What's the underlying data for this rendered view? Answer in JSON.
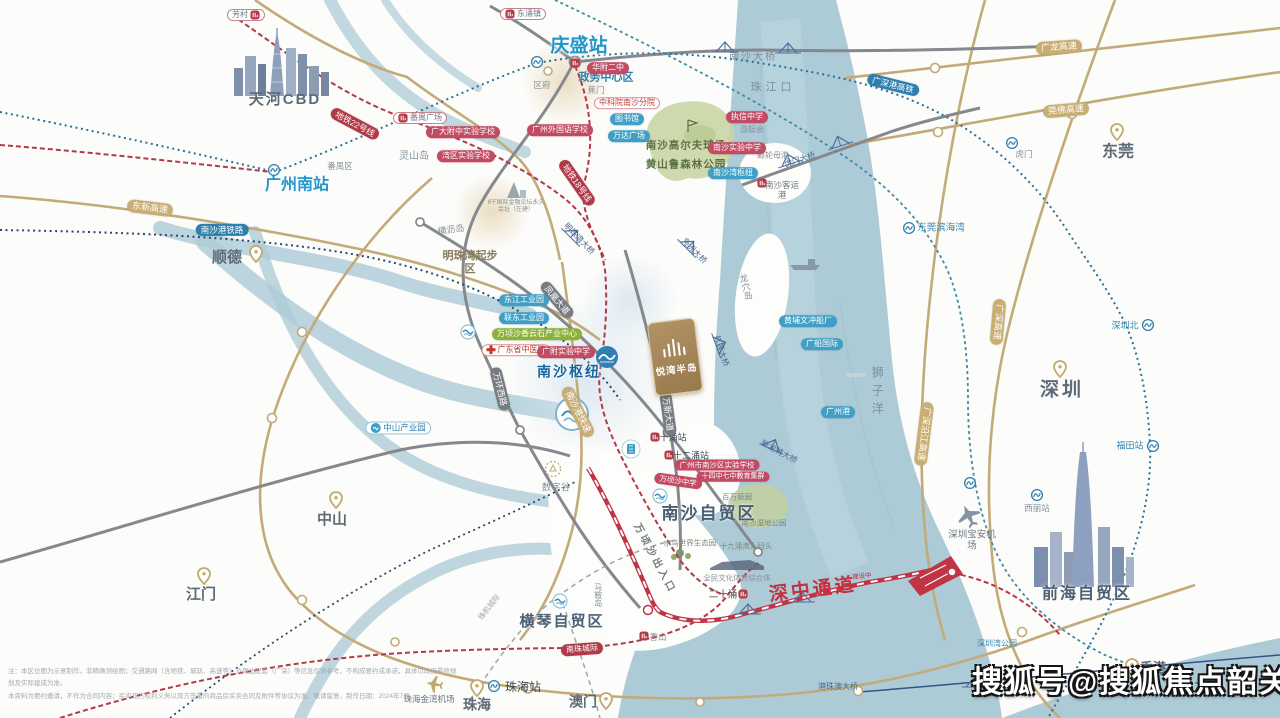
{
  "watermark": "搜狐号@搜狐焦点韶关站",
  "project": {
    "name": "悦湾半岛"
  },
  "disclaimer": {
    "line1": "注：本区位图为示意制作，非精确测绘图；交通路网（含地铁、城轨、高速等）及周边配套（广深）等信息仅供参考，不构成要约或承诺，具体以政府最终规划及实际建成为准。",
    "line2": "本资料为要约邀请，不作为合同内容；买卖双方权利义务以双方签署的商品房买卖合同及附件等协议为准。敬请留意，制作日期：2024年7月。"
  },
  "colors": {
    "water": "#adcbd7",
    "road_gold": "#c3aa79",
    "road_gray": "#85898d",
    "metro_red": "#b23a48",
    "rail_blue": "#2c6f96",
    "corridor_red": "#c03445",
    "station_blue": "#2196cb",
    "pill_red": "#c34a62",
    "pill_blue": "#3f9fc6",
    "pill_green": "#8ab236"
  },
  "labels": [
    {
      "n": "label-tianhe-cbd",
      "t": "天河CBD",
      "c": "city",
      "x": 285,
      "y": 100,
      "fs": 15,
      "ls": 2
    },
    {
      "n": "label-shunde",
      "t": "顺德",
      "c": "city",
      "x": 227,
      "y": 258,
      "fs": 15
    },
    {
      "n": "pin-shunde",
      "t": "",
      "c": "pin",
      "x": 256,
      "y": 254
    },
    {
      "n": "label-dongguan",
      "t": "东莞",
      "c": "city",
      "x": 1118,
      "y": 152,
      "fs": 16
    },
    {
      "n": "pin-dongguan",
      "t": "",
      "c": "pin",
      "x": 1117,
      "y": 132
    },
    {
      "n": "label-shenzhen",
      "t": "深圳",
      "c": "city",
      "x": 1062,
      "y": 391,
      "fs": 19,
      "ls": 3
    },
    {
      "n": "pin-shenzhen",
      "t": "",
      "c": "pin",
      "x": 1060,
      "y": 369
    },
    {
      "n": "label-zhongshan",
      "t": "中山",
      "c": "city",
      "x": 332,
      "y": 520,
      "fs": 15
    },
    {
      "n": "pin-zhongshan",
      "t": "",
      "c": "pin",
      "x": 336,
      "y": 500
    },
    {
      "n": "label-jiangmen",
      "t": "江门",
      "c": "city",
      "x": 201,
      "y": 595,
      "fs": 15
    },
    {
      "n": "pin-jiangmen",
      "t": "",
      "c": "pin",
      "x": 204,
      "y": 576
    },
    {
      "n": "label-zhuhai",
      "t": "珠海",
      "c": "city",
      "x": 477,
      "y": 705,
      "fs": 14
    },
    {
      "n": "pin-zhuhai",
      "t": "",
      "c": "pin",
      "x": 477,
      "y": 688
    },
    {
      "n": "label-aomen",
      "t": "澳门",
      "c": "city",
      "x": 583,
      "y": 702,
      "fs": 14
    },
    {
      "n": "pin-aomen",
      "t": "",
      "c": "pin",
      "x": 606,
      "y": 701
    },
    {
      "n": "label-xianggang",
      "t": "香港",
      "c": "city",
      "x": 1153,
      "y": 668,
      "fs": 13
    },
    {
      "n": "pin-xianggang",
      "t": "",
      "c": "pin",
      "x": 1132,
      "y": 667
    },
    {
      "n": "label-qingsheng-station",
      "t": "庆盛站",
      "c": "sta-blue",
      "x": 579,
      "y": 47,
      "fs": 19
    },
    {
      "n": "label-guangzhounan-station",
      "t": "广州南站",
      "c": "sta-blue",
      "x": 297,
      "y": 185,
      "fs": 16
    },
    {
      "n": "label-nansha-hub",
      "t": "南沙枢纽",
      "c": "hub",
      "x": 569,
      "y": 372,
      "fs": 14,
      "ls": 2
    },
    {
      "n": "label-zhujiangkou",
      "t": "珠江口",
      "c": "sea",
      "x": 773,
      "y": 88,
      "fs": 11,
      "ls": 4
    },
    {
      "n": "label-shiziyang",
      "t": "狮子洋",
      "c": "sea-v",
      "x": 877,
      "y": 393,
      "fs": 12,
      "ls": 6
    },
    {
      "n": "label-longxuedao",
      "t": "龙穴岛",
      "c": "isl-v",
      "x": 745,
      "y": 287,
      "fs": 9,
      "r": -14
    },
    {
      "n": "label-maandao",
      "t": "马鞍岛",
      "c": "isl-v",
      "x": 598,
      "y": 595,
      "fs": 8
    },
    {
      "n": "label-henglidao",
      "t": "横沥岛",
      "c": "isl",
      "x": 451,
      "y": 230,
      "fs": 9,
      "r": -8
    },
    {
      "n": "label-lingshandao",
      "t": "灵山岛",
      "c": "isl",
      "x": 414,
      "y": 157,
      "fs": 10
    },
    {
      "n": "label-panyuqu",
      "t": "番禺区",
      "c": "isl",
      "x": 340,
      "y": 166,
      "fs": 8.5
    },
    {
      "n": "label-qufu",
      "t": "区府",
      "c": "isl",
      "x": 542,
      "y": 85,
      "fs": 8.5
    },
    {
      "n": "label-jiaomen",
      "t": "蕉门",
      "c": "isl",
      "x": 596,
      "y": 90,
      "fs": 8.5
    },
    {
      "n": "label-shenzhenwan-park",
      "t": "深圳湾公园",
      "c": "small-blue",
      "x": 997,
      "y": 644,
      "fs": 8
    },
    {
      "n": "label-shenzhen-north",
      "t": "深圳北",
      "c": "small-blue",
      "x": 1125,
      "y": 326,
      "fs": 9
    },
    {
      "n": "label-futian-station",
      "t": "福田站",
      "c": "small-blue",
      "x": 1130,
      "y": 446,
      "fs": 9
    },
    {
      "n": "label-xili-station",
      "t": "西丽站",
      "c": "isl",
      "x": 1037,
      "y": 508,
      "fs": 8.5
    },
    {
      "n": "label-humen",
      "t": "虎门",
      "c": "isl",
      "x": 1024,
      "y": 154,
      "fs": 8.5
    },
    {
      "n": "label-dongguan-binhaiwan",
      "t": "东莞滨海湾",
      "c": "small-blue",
      "x": 941,
      "y": 228,
      "fs": 9.5
    },
    {
      "n": "label-zhuhai-station",
      "t": "珠海站",
      "c": "sta-dark",
      "x": 523,
      "y": 687,
      "fs": 12
    },
    {
      "n": "label-shuzigu",
      "t": "数字谷",
      "c": "isl",
      "x": 556,
      "y": 488,
      "fs": 9.5
    },
    {
      "n": "label-qianhai-zone",
      "t": "前海自贸区",
      "c": "zone",
      "x": 1087,
      "y": 594,
      "fs": 16,
      "ls": 2
    },
    {
      "n": "label-nansha-zone",
      "t": "南沙自贸区",
      "c": "zone",
      "x": 709,
      "y": 514,
      "fs": 17,
      "ls": 2
    },
    {
      "n": "label-hengqin-zone",
      "t": "横琴自贸区",
      "c": "zone",
      "x": 562,
      "y": 622,
      "fs": 15,
      "ls": 2
    },
    {
      "n": "label-shenzhong-corridor",
      "t": "深中通道",
      "c": "corridor",
      "x": 813,
      "y": 591,
      "fs": 19,
      "r": -7,
      "ls": 3
    },
    {
      "n": "label-corridor-note",
      "t": "建设中",
      "c": "corridor-sub",
      "x": 862,
      "y": 577,
      "fs": 6.5,
      "r": -7
    },
    {
      "n": "label-shenzhen-airport",
      "t": "深圳宝安机场",
      "c": "city-sm",
      "x": 972,
      "y": 541,
      "fs": 9.5,
      "w": 50
    },
    {
      "n": "label-zhuhai-airport",
      "t": "珠海金湾机场",
      "c": "city-sm",
      "x": 429,
      "y": 699,
      "fs": 8.5
    },
    {
      "n": "label-nansha-bridge",
      "t": "南沙大桥",
      "c": "sea",
      "x": 753,
      "y": 58,
      "fs": 10,
      "ls": 2
    },
    {
      "n": "label-hzm-bridge",
      "t": "港珠澳大桥",
      "c": "bridge",
      "x": 838,
      "y": 687,
      "fs": 8
    },
    {
      "n": "label-mingzhuwan",
      "t": "明珠湾起步区",
      "c": "dist",
      "x": 470,
      "y": 263,
      "fs": 11,
      "w": 56
    },
    {
      "n": "label-zhengwu",
      "t": "政务中心区",
      "c": "area",
      "x": 606,
      "y": 78,
      "fs": 11
    },
    {
      "n": "label-nansha-keyungang",
      "t": "南沙客运港",
      "c": "city-sm",
      "x": 782,
      "y": 190,
      "fs": 8.5,
      "w": 40
    },
    {
      "n": "label-youtinghui",
      "t": "游艇会",
      "c": "isl",
      "x": 752,
      "y": 130,
      "fs": 8
    },
    {
      "n": "label-youlun-mugang",
      "t": "邮轮母港",
      "c": "isl",
      "x": 773,
      "y": 156,
      "fs": 8
    },
    {
      "n": "label-nansha-golf",
      "t": "南沙高尔夫球场",
      "c": "park",
      "x": 686,
      "y": 146,
      "fs": 10.5,
      "ls": 1
    },
    {
      "n": "label-huangshanlu",
      "t": "黄山鲁森林公园",
      "c": "park",
      "x": 686,
      "y": 165,
      "fs": 10.5,
      "ls": 1
    },
    {
      "n": "label-nanshawan-hub",
      "t": "南沙湾枢纽",
      "c": "pill-blue",
      "x": 733,
      "y": 173,
      "fs": 8
    },
    {
      "n": "label-iff",
      "t": "IFF国际金融论坛永久会址（在建）",
      "c": "tiny",
      "x": 516,
      "y": 207,
      "fs": 6,
      "w": 58
    },
    {
      "n": "label-shuiniao",
      "t": "水鸟世界生态园",
      "c": "tiny2",
      "x": 690,
      "y": 543,
      "fs": 7.5
    },
    {
      "n": "label-baiwankuiyuan",
      "t": "百万葵园",
      "c": "tiny2",
      "x": 737,
      "y": 497,
      "fs": 7.5
    },
    {
      "n": "label-nansha-shidi",
      "t": "南沙湿地公园",
      "c": "tiny2",
      "x": 764,
      "y": 523,
      "fs": 7.5
    },
    {
      "n": "label-yurenmatou",
      "t": "十九涌渔人码头",
      "c": "tiny2",
      "x": 746,
      "y": 546,
      "fs": 7.5
    },
    {
      "n": "label-quanmin",
      "t": "全民文化体育综合体",
      "c": "tiny",
      "x": 737,
      "y": 578,
      "fs": 7.5
    },
    {
      "n": "label-wanqingsha-exit",
      "t": "万顷沙出入口",
      "c": "exit",
      "x": 654,
      "y": 559,
      "fs": 10,
      "r": 62,
      "ls": 3
    },
    {
      "n": "label-ershiyong",
      "t": "二十涌",
      "c": "sta-dark",
      "x": 723,
      "y": 595,
      "fs": 9.5
    },
    {
      "n": "label-xiangshan",
      "t": "香山",
      "c": "isl",
      "x": 658,
      "y": 637,
      "fs": 8.5
    },
    {
      "n": "label-shiyong-station",
      "t": "十涌站",
      "c": "sta-dark",
      "x": 673,
      "y": 438,
      "fs": 9
    },
    {
      "n": "label-shieryong-station",
      "t": "十二涌站",
      "c": "sta-dark",
      "x": 691,
      "y": 456,
      "fs": 9
    },
    {
      "n": "label-fangcun",
      "t": "芳村",
      "c": "pill-w",
      "x": 246,
      "y": 15,
      "fs": 8,
      "ic": "metro-red",
      "ip": "r"
    },
    {
      "n": "label-dongchongzhen",
      "t": "东涌镇",
      "c": "pill-w",
      "x": 523,
      "y": 14,
      "fs": 8,
      "ic": "metro-red",
      "ip": "l"
    },
    {
      "n": "label-panyu-square",
      "t": "番禺广场",
      "c": "pill-w",
      "x": 420,
      "y": 118,
      "fs": 8,
      "ic": "metro-red",
      "ip": "l"
    },
    {
      "n": "label-road-dongxin",
      "t": "东新高速",
      "c": "road-gold",
      "x": 150,
      "y": 208,
      "fs": 9,
      "r": 7
    },
    {
      "n": "label-road-guanglong",
      "t": "广龙高速",
      "c": "road-gold",
      "x": 1059,
      "y": 47,
      "fs": 9,
      "r": -4
    },
    {
      "n": "label-road-guanfo",
      "t": "莞佛高速",
      "c": "road-gold",
      "x": 1066,
      "y": 110,
      "fs": 9,
      "r": -5
    },
    {
      "n": "label-road-guangshen",
      "t": "广深高速",
      "c": "road-gold",
      "x": 998,
      "y": 322,
      "fs": 9,
      "r": 95
    },
    {
      "n": "label-road-yanjiang",
      "t": "广深沿江高速",
      "c": "road-gold",
      "x": 924,
      "y": 434,
      "fs": 9,
      "r": 97
    },
    {
      "n": "label-road-nanshagang",
      "t": "南沙港快速",
      "c": "road-gold",
      "x": 578,
      "y": 412,
      "fs": 9,
      "r": 63
    },
    {
      "n": "label-road-wanhuanxi",
      "t": "万环西路",
      "c": "road-dark",
      "x": 500,
      "y": 389,
      "fs": 8.5,
      "r": 76
    },
    {
      "n": "label-road-fenghuang",
      "t": "凤凰大道",
      "c": "road-dark",
      "x": 557,
      "y": 300,
      "fs": 8.5,
      "r": 50
    },
    {
      "n": "label-road-wanxin",
      "t": "万新大道",
      "c": "road-dark",
      "x": 668,
      "y": 414,
      "fs": 8.5,
      "r": 82
    },
    {
      "n": "label-road-metro22",
      "t": "地铁22号线",
      "c": "road-red",
      "x": 355,
      "y": 124,
      "fs": 8.5,
      "r": 28
    },
    {
      "n": "label-road-metro18",
      "t": "地铁18号线",
      "c": "road-red",
      "x": 577,
      "y": 183,
      "fs": 8.5,
      "r": 55
    },
    {
      "n": "label-road-nanzhu",
      "t": "南珠城际",
      "c": "road-red",
      "x": 582,
      "y": 649,
      "fs": 8,
      "r": -4
    },
    {
      "n": "label-road-nanshagang-railway",
      "t": "南沙港铁路",
      "c": "road-blue",
      "x": 222,
      "y": 230,
      "fs": 8.5
    },
    {
      "n": "label-road-gsg-hsr",
      "t": "广深港高铁",
      "c": "road-blue",
      "x": 893,
      "y": 85,
      "fs": 8.5,
      "r": 14
    },
    {
      "n": "label-humen-bridge",
      "t": "虎门大桥",
      "c": "bridge",
      "x": 800,
      "y": 160,
      "fs": 8,
      "r": -18
    },
    {
      "n": "label-mingzhuwan-bridge",
      "t": "明珠湾大桥",
      "c": "bridge",
      "x": 579,
      "y": 239,
      "fs": 8,
      "r": 46
    },
    {
      "n": "label-fuzhou-bridge",
      "t": "凫洲大桥",
      "c": "bridge",
      "x": 694,
      "y": 251,
      "fs": 8,
      "r": 46
    },
    {
      "n": "label-honglian-bridge",
      "t": "红莲大桥",
      "c": "bridge",
      "x": 721,
      "y": 351,
      "fs": 8,
      "r": 72
    },
    {
      "n": "label-xinlongte-bridge",
      "t": "新龙特大桥",
      "c": "bridge",
      "x": 779,
      "y": 452,
      "fs": 8,
      "r": 28
    },
    {
      "n": "label-road-zhuji",
      "t": "珠机城际",
      "c": "roadfaint",
      "x": 489,
      "y": 607,
      "fs": 7.5,
      "r": -52
    },
    {
      "n": "label-huafu2",
      "t": "华附二中",
      "c": "pill-red",
      "x": 608,
      "y": 68,
      "fs": 8
    },
    {
      "n": "label-gz-foreign-school",
      "t": "广州外国语学校",
      "c": "pill-red",
      "x": 560,
      "y": 130,
      "fs": 8
    },
    {
      "n": "label-gdfz-school",
      "t": "广大附中实验学校",
      "c": "pill-red",
      "x": 463,
      "y": 132,
      "fs": 8
    },
    {
      "n": "label-zhixin",
      "t": "执信中学",
      "c": "pill-red",
      "x": 747,
      "y": 117,
      "fs": 8
    },
    {
      "n": "label-wanqu-school",
      "t": "湾区实验学校",
      "c": "pill-red",
      "x": 466,
      "y": 156,
      "fs": 8
    },
    {
      "n": "label-zky",
      "t": "中科院南沙分院",
      "c": "pill-wr",
      "x": 627,
      "y": 103,
      "fs": 8
    },
    {
      "n": "label-library",
      "t": "图书馆",
      "c": "pill-blue",
      "x": 627,
      "y": 119,
      "fs": 8
    },
    {
      "n": "label-wanda",
      "t": "万达广场",
      "c": "pill-blue",
      "x": 629,
      "y": 136,
      "fs": 8
    },
    {
      "n": "label-nansha-middle",
      "t": "南沙实验中学",
      "c": "pill-red",
      "x": 737,
      "y": 148,
      "fs": 8
    },
    {
      "n": "label-wenchong",
      "t": "黄埔文冲船厂",
      "c": "pill-blue",
      "x": 808,
      "y": 321,
      "fs": 8
    },
    {
      "n": "label-guangchuan",
      "t": "广船国际",
      "c": "pill-blue",
      "x": 822,
      "y": 344,
      "fs": 8
    },
    {
      "n": "label-gzport",
      "t": "广州港",
      "c": "pill-blue",
      "x": 838,
      "y": 412,
      "fs": 8
    },
    {
      "n": "label-dongjiang-park",
      "t": "东江工业园",
      "c": "pill-blue",
      "x": 524,
      "y": 300,
      "fs": 8
    },
    {
      "n": "label-liandong-park",
      "t": "联东工业园",
      "c": "pill-blue",
      "x": 524,
      "y": 318,
      "fs": 8
    },
    {
      "n": "label-wqs-center",
      "t": "万顷沙香云石产业中心",
      "c": "pill-green",
      "x": 537,
      "y": 334,
      "fs": 8
    },
    {
      "n": "label-tcm-hospital",
      "t": "广东省中医院",
      "c": "pill-wr",
      "x": 516,
      "y": 350,
      "fs": 8,
      "ic": "cross",
      "ip": "l"
    },
    {
      "n": "label-gffz",
      "t": "广附实验中学",
      "c": "pill-red",
      "x": 566,
      "y": 352,
      "fs": 8
    },
    {
      "n": "label-zhongshan-park",
      "t": "中山产业园",
      "c": "pill-wb",
      "x": 398,
      "y": 428,
      "fs": 8.5,
      "ic": "dot-blue",
      "ip": "l"
    },
    {
      "n": "label-nanshaqu-school",
      "t": "广州市南沙区实验学校",
      "c": "pill-red",
      "x": 717,
      "y": 465,
      "fs": 7.5
    },
    {
      "n": "label-mingxiao-cluster",
      "t": "十四中七中教育集群",
      "c": "pill-red",
      "x": 733,
      "y": 477,
      "fs": 7
    },
    {
      "n": "label-wqs-middle",
      "t": "万顷沙中学",
      "c": "pill-red",
      "x": 678,
      "y": 481,
      "fs": 7.5,
      "r": 8
    },
    {
      "n": "icon-qingsheng-metro",
      "t": "",
      "c": "ic",
      "ic": "metro-blue",
      "x": 537,
      "y": 62
    },
    {
      "n": "icon-gznan-metro",
      "t": "",
      "c": "ic",
      "ic": "metro-blue",
      "x": 274,
      "y": 170
    },
    {
      "n": "icon-zhuhai-metro",
      "t": "",
      "c": "ic",
      "ic": "metro-blue",
      "x": 494,
      "y": 686
    },
    {
      "n": "icon-szbei-metro",
      "t": "",
      "c": "ic",
      "ic": "metro-blue",
      "x": 1148,
      "y": 325
    },
    {
      "n": "icon-futian-metro",
      "t": "",
      "c": "ic",
      "ic": "metro-blue",
      "x": 1153,
      "y": 446
    },
    {
      "n": "icon-xili-metro",
      "t": "",
      "c": "ic",
      "ic": "metro-blue",
      "x": 1037,
      "y": 495
    },
    {
      "n": "icon-humen-metro",
      "t": "",
      "c": "ic",
      "ic": "metro-blue",
      "x": 1012,
      "y": 143
    },
    {
      "n": "icon-binhaiwan-metro",
      "t": "",
      "c": "ic",
      "ic": "metro-blue",
      "x": 909,
      "y": 228
    },
    {
      "n": "icon-coast-metro",
      "t": "",
      "c": "ic",
      "ic": "metro-blue",
      "x": 970,
      "y": 483
    },
    {
      "n": "icon-keyungang-sta",
      "t": "",
      "c": "ic",
      "ic": "metro-red",
      "x": 762,
      "y": 183
    },
    {
      "n": "icon-ershiyong-sta",
      "t": "",
      "c": "ic",
      "ic": "metro-red",
      "x": 743,
      "y": 594
    },
    {
      "n": "icon-xiangshan-sta",
      "t": "",
      "c": "ic",
      "ic": "metro-red",
      "x": 644,
      "y": 636
    },
    {
      "n": "icon-shiyong-sta",
      "t": "",
      "c": "ic",
      "ic": "metro-red",
      "x": 655,
      "y": 437
    },
    {
      "n": "icon-shieryong-sta",
      "t": "",
      "c": "ic",
      "ic": "metro-red",
      "x": 669,
      "y": 455
    },
    {
      "n": "icon-qingsheng-sta",
      "t": "",
      "c": "ic",
      "ic": "metro-red",
      "x": 575,
      "y": 63
    },
    {
      "n": "icon-shuzigu",
      "t": "",
      "c": "ic",
      "ic": "circle-gold",
      "x": 553,
      "y": 469
    },
    {
      "n": "icon-nansha-zone-wave",
      "t": "",
      "c": "ic",
      "ic": "wave",
      "x": 660,
      "y": 496
    },
    {
      "n": "icon-hengqin-zone-wave",
      "t": "",
      "c": "ic",
      "ic": "wave",
      "x": 560,
      "y": 601
    },
    {
      "n": "icon-dongchong-wave",
      "t": "",
      "c": "ic",
      "ic": "wave",
      "x": 468,
      "y": 332
    }
  ]
}
